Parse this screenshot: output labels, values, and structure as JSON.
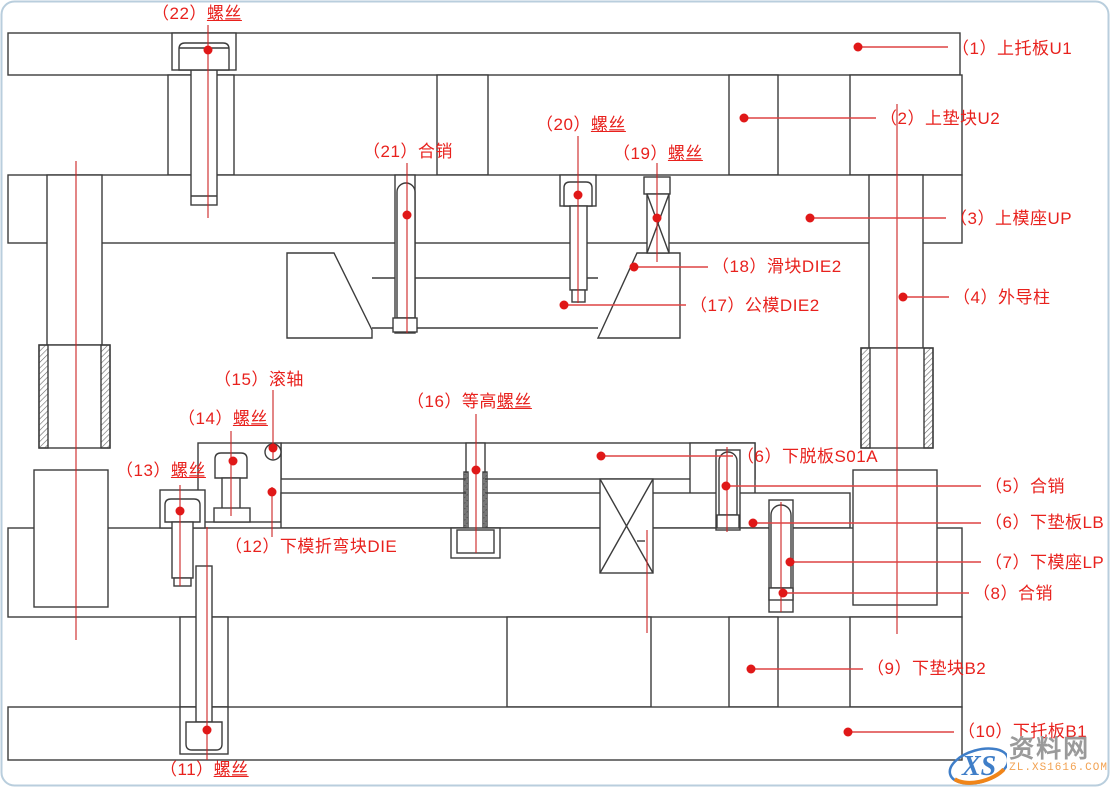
{
  "parts": [
    {
      "num": "（1）",
      "name": "上托板U1",
      "name_u": ""
    },
    {
      "num": "（2）",
      "name": "上垫块U2",
      "name_u": ""
    },
    {
      "num": "（3）",
      "name": "上模座UP",
      "name_u": ""
    },
    {
      "num": "（4）",
      "name": "外导柱",
      "name_u": ""
    },
    {
      "num": "（5）",
      "name": "合销",
      "name_u": ""
    },
    {
      "num": "（6）",
      "name": "下脱板S01A",
      "name_u": ""
    },
    {
      "num": "（6）",
      "name": "下垫板LB",
      "name_u": ""
    },
    {
      "num": "（7）",
      "name": "下模座LP",
      "name_u": ""
    },
    {
      "num": "（8）",
      "name": "合销",
      "name_u": ""
    },
    {
      "num": "（9）",
      "name": "下垫块B2",
      "name_u": ""
    },
    {
      "num": "（10）",
      "name": "下托板B1",
      "name_u": ""
    },
    {
      "num": "（11）",
      "name": "",
      "name_u": "螺丝"
    },
    {
      "num": "（12）",
      "name": "下模折弯块DIE",
      "name_u": ""
    },
    {
      "num": "（13）",
      "name": "",
      "name_u": "螺丝"
    },
    {
      "num": "（14）",
      "name": "",
      "name_u": "螺丝"
    },
    {
      "num": "（15）",
      "name": "滚轴",
      "name_u": ""
    },
    {
      "num": "（16）",
      "name": "等高",
      "name_u": "螺丝"
    },
    {
      "num": "（17）",
      "name": "公模DIE2",
      "name_u": ""
    },
    {
      "num": "（18）",
      "name": "滑块DIE2",
      "name_u": ""
    },
    {
      "num": "（19）",
      "name": "",
      "name_u": "螺丝"
    },
    {
      "num": "（20）",
      "name": "",
      "name_u": "螺丝"
    },
    {
      "num": "（21）",
      "name": "合销",
      "name_u": ""
    },
    {
      "num": "（22）",
      "name": "",
      "name_u": "螺丝"
    }
  ],
  "watermark": {
    "logo_text": "XS",
    "site_name": "资料网",
    "site_url": "ZL.XS1616.COM"
  },
  "colors": {
    "callout_red": "#e8211d",
    "leader_red": "#dd4444",
    "centerline_red": "#cc2222",
    "linework": "#3c3c3c",
    "frame": "#b9cedd",
    "watermark_gray": "#9a9a9a",
    "watermark_orange": "#f08519",
    "watermark_blue": "#3f7ec8"
  }
}
